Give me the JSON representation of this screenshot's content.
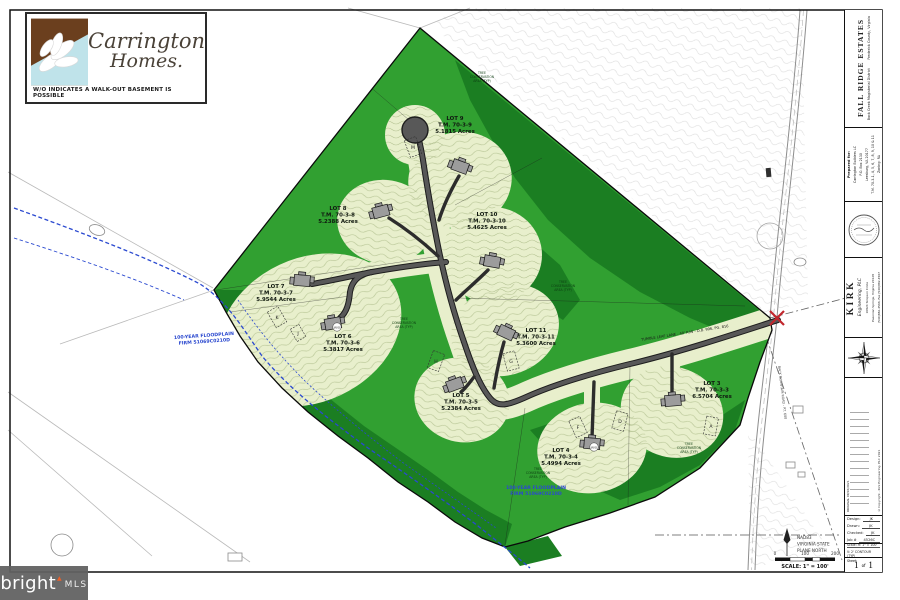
{
  "logo": {
    "line1": "Carrington",
    "line2": "Homes.",
    "tagline": "W/O INDICATES A WALK-OUT BASEMENT IS POSSIBLE"
  },
  "map": {
    "lots": [
      {
        "name": "LOT 9",
        "tm": "T.M. 70-3-9",
        "acres": "5.1815 Acres"
      },
      {
        "name": "LOT 8",
        "tm": "T.M. 70-3-8",
        "acres": "5.2388 Acres"
      },
      {
        "name": "LOT 10",
        "tm": "T.M. 70-3-10",
        "acres": "5.4625 Acres"
      },
      {
        "name": "LOT 7",
        "tm": "T.M. 70-3-7",
        "acres": "5.9544 Acres"
      },
      {
        "name": "LOT 6",
        "tm": "T.M. 70-3-6",
        "acres": "5.3817 Acres"
      },
      {
        "name": "LOT 11",
        "tm": "T.M. 70-3-11",
        "acres": "5.3600 Acres"
      },
      {
        "name": "LOT 5",
        "tm": "T.M. 70-3-5",
        "acres": "5.2384 Acres"
      },
      {
        "name": "LOT 4",
        "tm": "T.M. 70-3-4",
        "acres": "5.4994 Acres"
      },
      {
        "name": "LOT 3",
        "tm": "T.M. 70-3-3",
        "acres": "6.5704 Acres"
      }
    ],
    "boxes": [
      "M",
      "K",
      "J",
      "H",
      "G",
      "F",
      "D",
      "A"
    ],
    "wo": "W/O",
    "tca": [
      "TREE",
      "CONSERVATION",
      "AREA (TYP)"
    ],
    "floodplain": [
      "100-YEAR FLOODPLAIN",
      "FIRM 51069C0210D"
    ],
    "road_label": "TUMBLE LEAF LANE - 40' R/W - D.B. 996, PG. 816",
    "back_road_label": "BACK MOUNTAIN ROAD - RT. 600"
  },
  "footer": {
    "datum": [
      "NAD83",
      "VIRGINIA STATE",
      "PLANE NORTH"
    ],
    "scalebar": {
      "ticks": [
        "0",
        "100",
        "200"
      ],
      "label": "SCALE: 1\" = 100'"
    }
  },
  "titleblock": {
    "project": "FALL RIDGE ESTATES",
    "district": "Back Creek Magisterial District        Frederick County, Virginia",
    "prepared": [
      "Prepared for:",
      "Carrington Builders LC",
      "P.O. Box 2130",
      "Leesburg, VA 20177",
      "T.M. 70-3-1, 4, 5, 6, 7, 8, 9, 10 & 11",
      "Zoning: RA"
    ],
    "firm": {
      "name": "KIRK",
      "sub": "Engineering, PLC",
      "addr": [
        "16924 Simpson Circle",
        "Paeonian Springs, Virginia 20129",
        "(540)882-4566, Fax (540)882-4567"
      ]
    },
    "revisions": {
      "note": "ORIGINAL",
      "date": "09/16/2021"
    },
    "copyright": "©Copyright - Kirk Engineering, PLC  2021",
    "credits": [
      {
        "label": "Design:",
        "value": "JK"
      },
      {
        "label": "Drawn:",
        "value": "JK"
      },
      {
        "label": "Checked:",
        "value": "JK"
      },
      {
        "label": "Job #",
        "value": "4526C"
      }
    ],
    "scale": [
      "Scale:  H: 1\" = 100'",
      "V: 2' CONTOUR (TYP)"
    ],
    "sheet": {
      "label": "Sheet:",
      "num": "1",
      "of": "of",
      "total": "1"
    }
  },
  "watermark": {
    "brand": "bright",
    "mls": "MLS"
  }
}
